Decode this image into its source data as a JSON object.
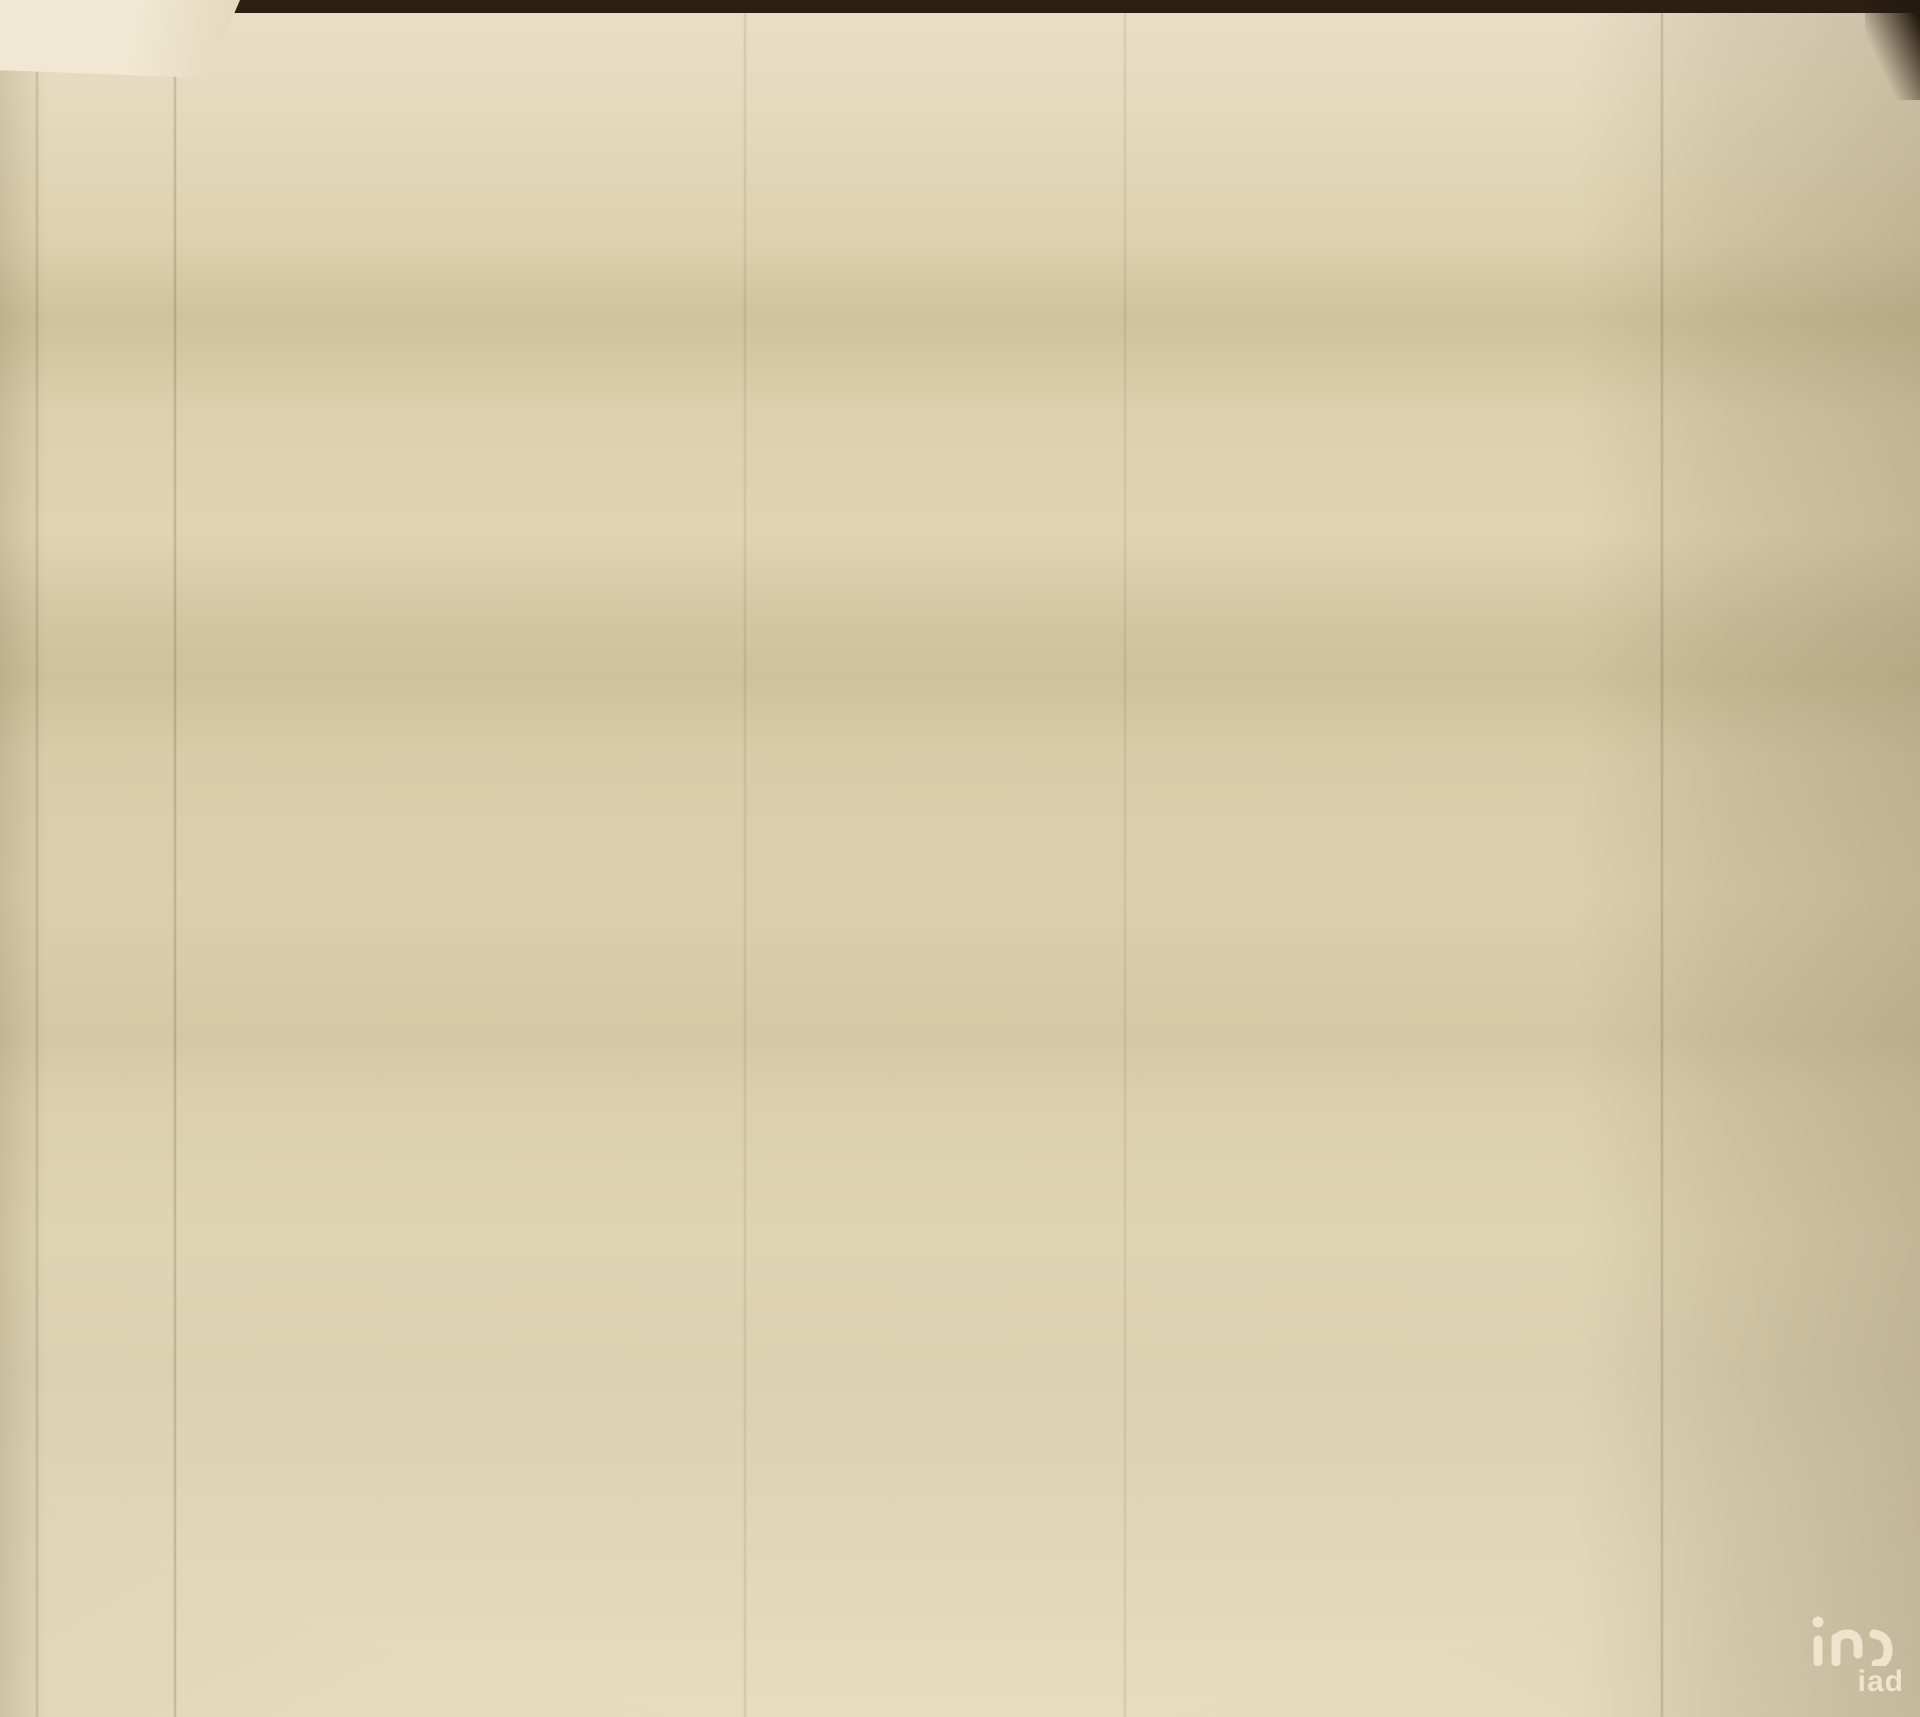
{
  "document": {
    "type": "architectural floor plan (photographed drawing)",
    "floor_title": "R/CHÃO",
    "watermark": {
      "text": "iad"
    }
  },
  "colors": {
    "paper": "#ddd1b0",
    "wall_ink": "#6f5e42",
    "dim_ink": "#54452e",
    "title_ink": "#241b10",
    "photo_background": "#2b1f12",
    "watermark": "#f1e9d2"
  },
  "rooms": [
    {
      "name": "QUARTO"
    },
    {
      "name": "QUARTO"
    },
    {
      "name": "ESCRITÓRIO"
    },
    {
      "name": "COZINHA"
    },
    {
      "name": "COMER"
    },
    {
      "name": "ESTAR"
    },
    {
      "name": "HALL"
    }
  ],
  "section_markers": [
    "E",
    "H",
    "F",
    "A"
  ],
  "labels": [
    {
      "t": "12.85",
      "x": 517,
      "y": 84
    },
    {
      "t": "2.20",
      "x": 292,
      "y": 108
    },
    {
      "t": "4.45",
      "x": 435,
      "y": 110
    },
    {
      "t": "2.20",
      "x": 587,
      "y": 112
    },
    {
      "t": "2.25",
      "x": 688,
      "y": 115
    },
    {
      "t": "1.75",
      "x": 940,
      "y": 118
    },
    {
      "t": "0.75",
      "x": 230,
      "y": 129,
      "k": "s"
    },
    {
      "t": "0.55",
      "x": 256,
      "y": 131,
      "k": "s"
    },
    {
      "t": "0.90",
      "x": 291,
      "y": 132,
      "k": "s"
    },
    {
      "t": "1.10",
      "x": 323,
      "y": 134,
      "k": "s"
    },
    {
      "t": "3.35",
      "x": 416,
      "y": 129
    },
    {
      "t": "0.50",
      "x": 498,
      "y": 123,
      "k": "s"
    },
    {
      "t": "0.50",
      "x": 525,
      "y": 125,
      "k": "s"
    },
    {
      "t": "0.65",
      "x": 558,
      "y": 130,
      "k": "s"
    },
    {
      "t": "0.80",
      "x": 593,
      "y": 131,
      "k": "s"
    },
    {
      "t": "0.65",
      "x": 621,
      "y": 134,
      "k": "s"
    },
    {
      "t": "0.50",
      "x": 649,
      "y": 136,
      "k": "s"
    },
    {
      "t": "0.50",
      "x": 673,
      "y": 137,
      "k": "s"
    },
    {
      "t": "1.25",
      "x": 828,
      "y": 116,
      "k": "s"
    },
    {
      "t": "0.70",
      "x": 145,
      "y": 223
    },
    {
      "t": "1.25",
      "x": 160,
      "y": 281
    },
    {
      "t": "1.20",
      "x": 160,
      "y": 346
    },
    {
      "t": "6.15",
      "x": 130,
      "y": 407
    },
    {
      "t": "4.75",
      "x": 156,
      "y": 420
    },
    {
      "t": "1.20",
      "x": 158,
      "y": 502
    },
    {
      "t": "0.70",
      "x": 146,
      "y": 553
    },
    {
      "t": "0.90",
      "x": 140,
      "y": 598
    },
    {
      "t": "16.80",
      "x": 93,
      "y": 633
    },
    {
      "t": "1.20",
      "x": 136,
      "y": 633
    },
    {
      "t": "4.70",
      "x": 117,
      "y": 868
    },
    {
      "t": "2.60",
      "x": 134,
      "y": 936
    },
    {
      "t": "3.45",
      "x": 110,
      "y": 1139
    },
    {
      "t": "1.80",
      "x": 105,
      "y": 1303
    },
    {
      "t": "2.75",
      "x": 1518,
      "y": 268
    },
    {
      "t": "1.70",
      "x": 1500,
      "y": 390
    },
    {
      "t": "1.20",
      "x": 1502,
      "y": 467
    },
    {
      "t": "6.35",
      "x": 1528,
      "y": 488
    },
    {
      "t": "2.35",
      "x": 1502,
      "y": 547
    },
    {
      "t": "0.90",
      "x": 1502,
      "y": 607
    },
    {
      "t": "16.80",
      "x": 1542,
      "y": 648
    },
    {
      "t": "1.10",
      "x": 1502,
      "y": 664
    },
    {
      "t": "1.05",
      "x": 1502,
      "y": 733
    },
    {
      "t": "0.30",
      "x": 1502,
      "y": 772
    },
    {
      "t": "1.80",
      "x": 1540,
      "y": 790
    },
    {
      "t": "0.90",
      "x": 1502,
      "y": 816
    },
    {
      "t": "0.30",
      "x": 1502,
      "y": 855
    },
    {
      "t": "5.15",
      "x": 1524,
      "y": 997
    },
    {
      "t": "1.25",
      "x": 239,
      "y": 1560
    },
    {
      "t": "0.90",
      "x": 283,
      "y": 1560
    },
    {
      "t": "0.60",
      "x": 324,
      "y": 1558
    },
    {
      "t": "2.00",
      "x": 385,
      "y": 1557
    },
    {
      "t": "0.55",
      "x": 442,
      "y": 1556
    },
    {
      "t": "0.55",
      "x": 468,
      "y": 1554
    },
    {
      "t": "7.00",
      "x": 525,
      "y": 1552
    },
    {
      "t": "0.55",
      "x": 580,
      "y": 1550
    },
    {
      "t": "7.00",
      "x": 655,
      "y": 1548
    },
    {
      "t": "0.55",
      "x": 862,
      "y": 1549
    },
    {
      "t": "0.55",
      "x": 1063,
      "y": 1547
    },
    {
      "t": "0.75",
      "x": 1095,
      "y": 1549
    },
    {
      "t": "1.00",
      "x": 1142,
      "y": 1546
    },
    {
      "t": "0.50",
      "x": 1200,
      "y": 1548
    },
    {
      "t": "2.05",
      "x": 1290,
      "y": 1542
    },
    {
      "t": "2.25",
      "x": 256,
      "y": 1580
    },
    {
      "t": "3.15",
      "x": 379,
      "y": 1576
    },
    {
      "t": "5.70",
      "x": 578,
      "y": 1571
    },
    {
      "t": "1.75",
      "x": 1143,
      "y": 1566
    },
    {
      "t": "12.85",
      "x": 478,
      "y": 1592
    },
    {
      "t": "0.10",
      "x": 308,
      "y": 1516,
      "k": "s",
      "r": -90
    },
    {
      "t": "QUARTO",
      "x": 572,
      "y": 396,
      "k": "r"
    },
    {
      "t": "0.25",
      "x": 463,
      "y": 336
    },
    {
      "t": "4.25",
      "x": 613,
      "y": 321
    },
    {
      "t": "3.00",
      "x": 487,
      "y": 410
    },
    {
      "t": "0.15",
      "x": 752,
      "y": 334
    },
    {
      "t": "1.70",
      "x": 847,
      "y": 298
    },
    {
      "t": "1.15",
      "x": 828,
      "y": 345
    },
    {
      "t": "2.60",
      "x": 828,
      "y": 365
    },
    {
      "t": "QUARTO",
      "x": 557,
      "y": 610,
      "k": "r"
    },
    {
      "t": "2.80",
      "x": 470,
      "y": 602
    },
    {
      "t": "0.25",
      "x": 447,
      "y": 684
    },
    {
      "t": "4.25",
      "x": 575,
      "y": 668
    },
    {
      "t": "0.15",
      "x": 628,
      "y": 560,
      "k": "s"
    },
    {
      "t": "ESCRITÓRIO",
      "x": 968,
      "y": 583,
      "k": "r"
    },
    {
      "t": "1.70",
      "x": 793,
      "y": 499
    },
    {
      "t": "0.15",
      "x": 884,
      "y": 514
    },
    {
      "t": "2.75",
      "x": 982,
      "y": 502
    },
    {
      "t": "1.90",
      "x": 1032,
      "y": 617
    },
    {
      "t": "1.10",
      "x": 802,
      "y": 620
    },
    {
      "t": "0.25",
      "x": 1096,
      "y": 452,
      "k": "s",
      "r": 90
    },
    {
      "t": "1.5",
      "x": 578,
      "y": 658,
      "k": "s"
    },
    {
      "t": "2.00",
      "x": 601,
      "y": 672,
      "k": "s"
    },
    {
      "t": "3.45",
      "x": 421,
      "y": 827
    },
    {
      "t": "1.70",
      "x": 338,
      "y": 883
    },
    {
      "t": "COZINHA",
      "x": 406,
      "y": 881,
      "k": "r"
    },
    {
      "t": "3.30",
      "x": 512,
      "y": 883
    },
    {
      "t": "2.10",
      "x": 365,
      "y": 967
    },
    {
      "t": "0.15",
      "x": 472,
      "y": 993,
      "k": "s",
      "r": -90
    },
    {
      "t": "0.25",
      "x": 233,
      "y": 800,
      "k": "s",
      "r": -90
    },
    {
      "t": "COMER",
      "x": 525,
      "y": 1132,
      "k": "r"
    },
    {
      "t": "4.20",
      "x": 445,
      "y": 1131
    },
    {
      "t": "0.25",
      "x": 368,
      "y": 1246
    },
    {
      "t": "3.90",
      "x": 444,
      "y": 1239
    },
    {
      "t": "0.15",
      "x": 538,
      "y": 1243
    },
    {
      "t": "ESTAR",
      "x": 814,
      "y": 1203,
      "k": "r"
    },
    {
      "t": "5.00",
      "x": 767,
      "y": 1166
    },
    {
      "t": "3.35",
      "x": 815,
      "y": 948
    },
    {
      "t": "0.15",
      "x": 962,
      "y": 964
    },
    {
      "t": "HALL",
      "x": 1023,
      "y": 965,
      "k": "r"
    },
    {
      "t": "3.45",
      "x": 1052,
      "y": 947
    },
    {
      "t": "2.05",
      "x": 1078,
      "y": 983
    },
    {
      "t": "0.25",
      "x": 1082,
      "y": 895,
      "k": "s",
      "r": -90
    },
    {
      "t": "0.25",
      "x": 1190,
      "y": 960,
      "k": "s"
    },
    {
      "t": "2.30",
      "x": 762,
      "y": 926
    },
    {
      "t": "0.15",
      "x": 697,
      "y": 967,
      "k": "s"
    },
    {
      "t": "0.15",
      "x": 695,
      "y": 1008,
      "k": "s"
    },
    {
      "t": "0.25",
      "x": 567,
      "y": 1414
    },
    {
      "t": "5.20",
      "x": 707,
      "y": 1412
    },
    {
      "t": "0.25",
      "x": 856,
      "y": 1413
    },
    {
      "t": "0.25",
      "x": 630,
      "y": 1447,
      "k": "s",
      "r": -90
    },
    {
      "t": "E",
      "x": 176,
      "y": 22,
      "k": "m"
    },
    {
      "t": "H",
      "x": 942,
      "y": 50,
      "k": "m"
    },
    {
      "t": "F",
      "x": 174,
      "y": 1118,
      "k": "m"
    },
    {
      "t": "A",
      "x": 733,
      "y": 1214,
      "k": "m",
      "r": -90
    },
    {
      "t": "R/CHÃO",
      "x": 1205,
      "y": 1652,
      "k": "t"
    }
  ]
}
